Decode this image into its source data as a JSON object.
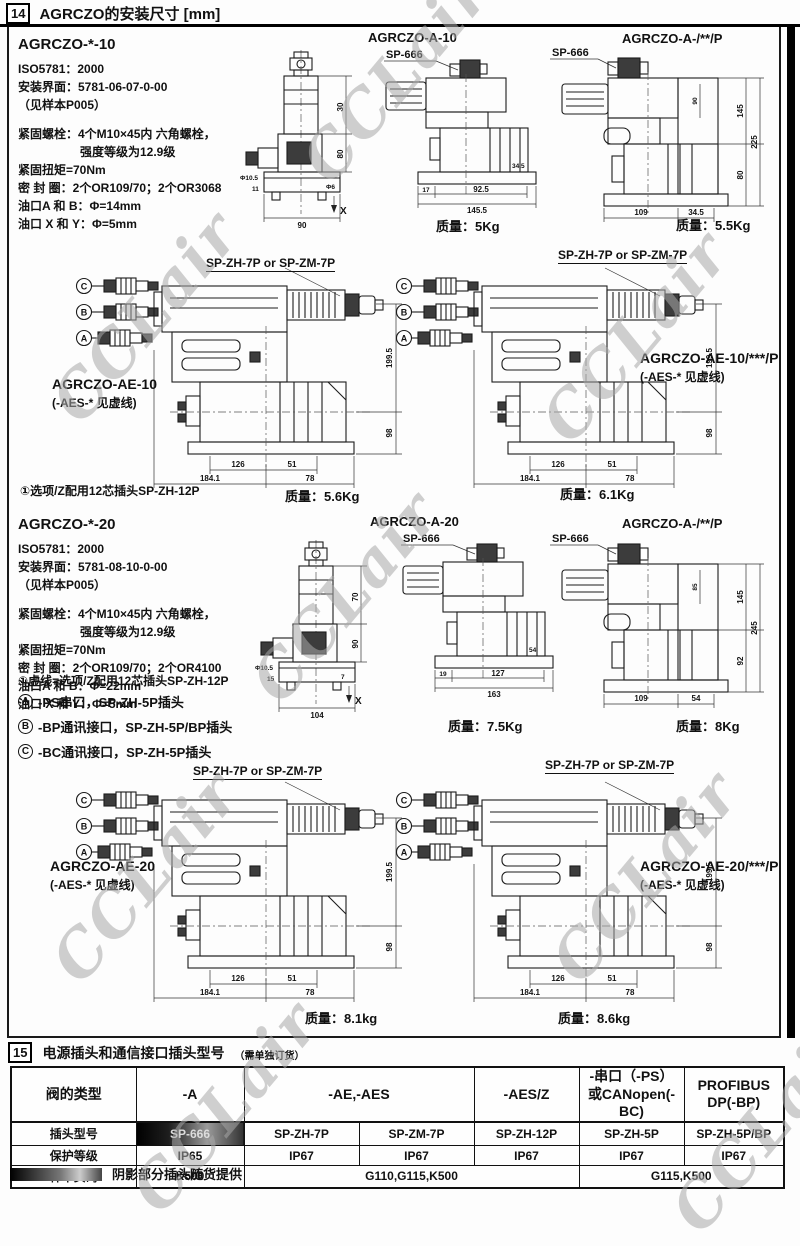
{
  "hdr": {
    "num": "14",
    "title": "AGRCZO的安装尺寸 [mm]"
  },
  "wm": {
    "text": "CCLair"
  },
  "spec10": {
    "model": "AGRCZO-*-10",
    "l1": "ISO5781：2000",
    "l2": "安装界面：5781-06-07-0-00",
    "l3": "（见样本P005）",
    "l4": "紧固螺栓：4个M10×45内 六角螺栓，",
    "l5": "强度等级为12.9级",
    "l6": "紧固扭矩=70Nm",
    "l7": "密 封 圈：2个OR109/70；2个OR3068",
    "l8": "油口A 和 B：Φ=14mm",
    "l9": "油口 X 和 Y：Φ=5mm"
  },
  "spec20": {
    "model": "AGRCZO-*-20",
    "l1": "ISO5781：2000",
    "l2": "安装界面：5781-08-10-0-00",
    "l3": "（见样本P005）",
    "l4": "紧固螺栓：4个M10×45内 六角螺栓，",
    "l5": "强度等级为12.9级",
    "l6": "紧固扭矩=70Nm",
    "l7": "密 封 圈：2个OR109/70；2个OR4100",
    "l8": "油口A 和 B：Φ=22mm",
    "l9": "油口 X 和 Y：Φ=5mm"
  },
  "labels": {
    "t_a10": "AGRCZO-A-10",
    "w_a10": "质量：5Kg",
    "t_a10p": "AGRCZO-A-/**/P",
    "w_a10p": "质量：5.5Kg",
    "t_a20": "AGRCZO-A-20",
    "w_a20": "质量：7.5Kg",
    "t_a20p": "AGRCZO-A-/**/P",
    "w_a20p": "质量：8Kg"
  },
  "d10_front": {
    "dims": {
      "v1": "30",
      "v2": "80",
      "b1": "90",
      "s1": "Φ10.5",
      "s2": "11",
      "s3": "Φ6",
      "ax": "X"
    }
  },
  "d10_side": {
    "plug": "SP-666",
    "dims": {
      "b1": "17",
      "b2": "92.5",
      "b3": "145.5",
      "s1": "34.5"
    }
  },
  "d10p": {
    "plug": "SP-666",
    "dims": {
      "v1": "145",
      "v2": "225",
      "v3": "80",
      "s1": "90",
      "b1": "109",
      "b2": "34.5"
    }
  },
  "d20_front": {
    "dims": {
      "v1": "70",
      "v2": "90",
      "b1": "104",
      "s1": "Φ10.5",
      "s2": "15",
      "s3": "7",
      "ax": "X"
    }
  },
  "d20_side": {
    "plug": "SP-666",
    "dims": {
      "b1": "19",
      "b2": "127",
      "b3": "163",
      "s1": "54"
    }
  },
  "d20p": {
    "plug": "SP-666",
    "dims": {
      "v1": "145",
      "v2": "245",
      "v3": "92",
      "s1": "85",
      "b1": "109",
      "b2": "54"
    }
  },
  "note10": "①选项/Z配用12芯插头SP-ZH-12P",
  "ae10": {
    "plug_label": "SP-ZH-7P or SP-ZM-7P",
    "model": "AGRCZO-AE-10",
    "note": "(-AES-* 见虚线)",
    "weight": "质量：5.6Kg",
    "conn": [
      "C",
      "B",
      "A"
    ],
    "dims": {
      "v1": "199.5",
      "v2": "98",
      "b1": "126",
      "b2": "51",
      "b3": "184.1",
      "b4": "78"
    }
  },
  "ae10p": {
    "plug_label": "SP-ZH-7P or SP-ZM-7P",
    "model": "AGRCZO-AE-10/***/P",
    "note": "(-AES-* 见虚线)",
    "weight": "质量：6.1Kg",
    "conn": [
      "C",
      "B",
      "A"
    ],
    "dims": {
      "v1": "199.5",
      "v2": "98",
      "b1": "126",
      "b2": "51",
      "b3": "184.1",
      "b4": "78"
    }
  },
  "ae20": {
    "plug_label": "SP-ZH-7P or SP-ZM-7P",
    "model": "AGRCZO-AE-20",
    "note": "(-AES-* 见虚线)",
    "weight": "质量：8.1kg",
    "conn": [
      "C",
      "B",
      "A"
    ],
    "dims": {
      "v1": "199.5",
      "v2": "98",
      "b1": "126",
      "b2": "51",
      "b3": "184.1",
      "b4": "78"
    }
  },
  "ae20p": {
    "plug_label": "SP-ZH-7P or SP-ZM-7P",
    "model": "AGRCZO-AE-20/***/P",
    "note": "(-AES-* 见虚线)",
    "weight": "质量：8.6kg",
    "conn": [
      "C",
      "B",
      "A"
    ],
    "dims": {
      "v1": "199.5",
      "v2": "98",
      "b1": "126",
      "b2": "51",
      "b3": "184.1",
      "b4": "78"
    }
  },
  "notes20": {
    "dashed": "①虚线=选项/Z配用12芯插头SP-ZH-12P",
    "items": [
      {
        "letter": "A",
        "text": "-PS串口，SP-ZH-5P插头"
      },
      {
        "letter": "B",
        "text": "-BP通讯接口，SP-ZH-5P/BP插头"
      },
      {
        "letter": "C",
        "text": "-BC通讯接口，SP-ZH-5P插头"
      }
    ]
  },
  "sec15": {
    "num": "15",
    "title": "电源插头和通信接口插头型号",
    "subtitle": "（需单独订货）",
    "rows": {
      "r1": "阀的类型",
      "r2": "插头型号",
      "r3": "保护等级",
      "r4": "样本页码"
    },
    "types": {
      "a": "-A",
      "ae": "-AE,-AES",
      "aesz": "-AES/Z",
      "ps1": "-串口（-PS）",
      "ps2": "或CANopen(-BC)",
      "profibus": "PROFIBUS DP(-BP)"
    },
    "plugs": [
      "SP-666",
      "SP-ZH-7P",
      "SP-ZM-7P",
      "SP-ZH-12P",
      "SP-ZH-5P",
      "SP-ZH-5P/BP"
    ],
    "ip": [
      "IP65",
      "IP67",
      "IP67",
      "IP67",
      "IP67",
      "IP67"
    ],
    "pages": [
      "K500",
      "G110,G115,K500",
      "G115,K500"
    ],
    "footnote": "阴影部分插头随货提供"
  }
}
